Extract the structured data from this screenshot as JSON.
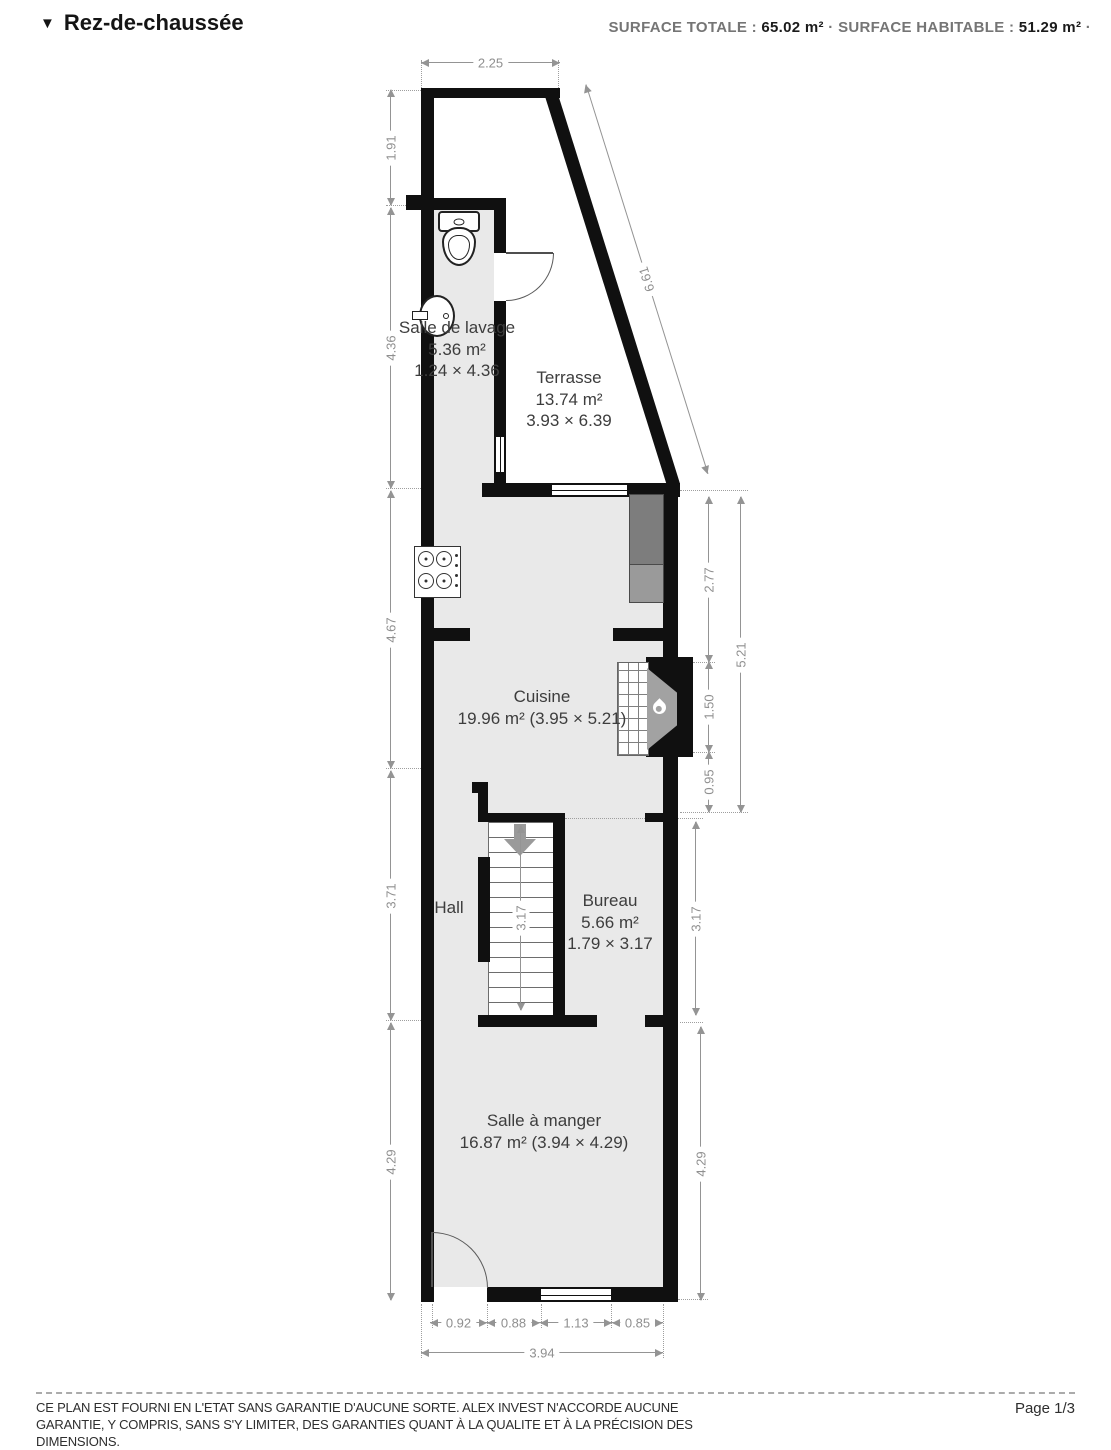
{
  "header": {
    "collapse_icon": "▼",
    "title": "Rez-de-chaussée",
    "surface_total_label": "SURFACE TOTALE :",
    "surface_total_value": "65.02 m²",
    "separator": "·",
    "surface_habitable_label": "SURFACE HABITABLE :",
    "surface_habitable_value": "51.29 m²",
    "trailing_separator": "·"
  },
  "rooms": {
    "salle_de_lavage": {
      "name": "Salle de lavage",
      "area": "5.36 m²",
      "dimensions": "1.24 × 4.36"
    },
    "terrasse": {
      "name": "Terrasse",
      "area": "13.74 m²",
      "dimensions": "3.93 × 6.39"
    },
    "cuisine": {
      "name": "Cuisine",
      "area_dimensions": "19.96 m² (3.95 × 5.21)"
    },
    "hall": {
      "name": "Hall"
    },
    "bureau": {
      "name": "Bureau",
      "area": "5.66 m²",
      "dimensions": "1.79 × 3.17"
    },
    "salle_a_manger": {
      "name": "Salle à manger",
      "area_dimensions": "16.87 m² (3.94 × 4.29)"
    }
  },
  "dims": {
    "top": "2.25",
    "diagonal": "6.61",
    "left": [
      "1.91",
      "4.36",
      "4.67",
      "3.71",
      "4.29"
    ],
    "right": [
      "2.77",
      "1.50",
      "0.95",
      "5.21",
      "3.17",
      "4.29"
    ],
    "stairs": "3.17",
    "bottom": [
      "0.92",
      "0.88",
      "1.13",
      "0.85"
    ],
    "bottom_total": "3.94"
  },
  "footer": {
    "disclaimer": "CE PLAN EST FOURNI EN L'ETAT SANS GARANTIE D'AUCUNE SORTE. ALEX INVEST N'ACCORDE AUCUNE GARANTIE, Y COMPRIS, SANS S'Y LIMITER, DES GARANTIES QUANT À LA QUALITE ET À LA PRÉCISION DES DIMENSIONS.",
    "page": "Page 1/3"
  },
  "colors": {
    "wall": "#101010",
    "floor": "#e9e9e9",
    "dimension": "#949494",
    "room_label": "#3d3d3d"
  }
}
